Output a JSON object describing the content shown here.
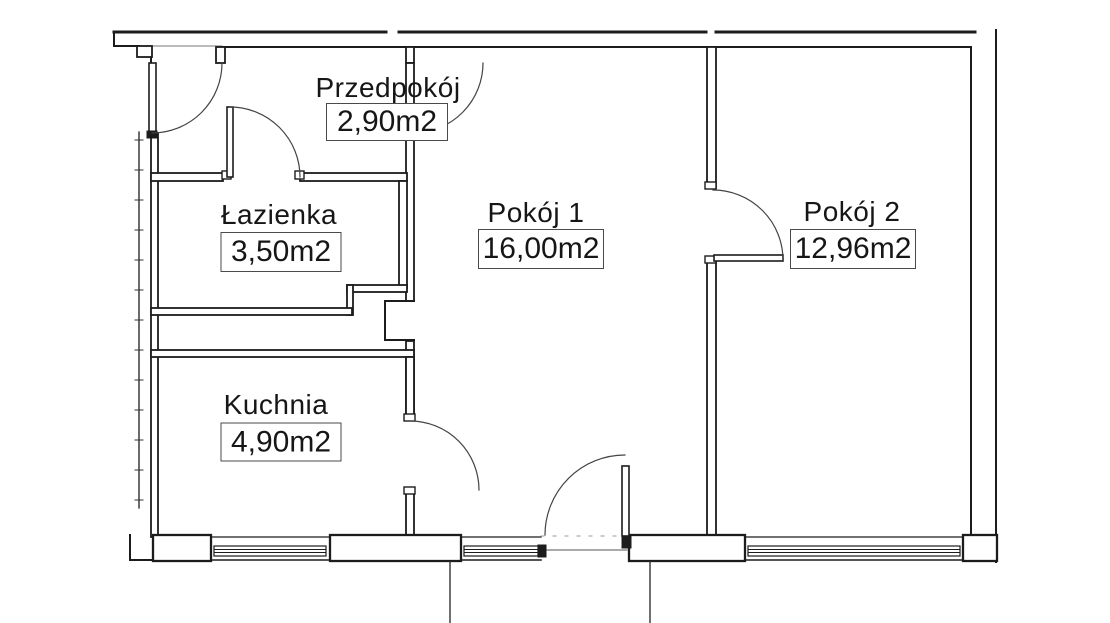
{
  "plan": {
    "background": "#ffffff",
    "line_color": "#1c1c1c",
    "rooms": [
      {
        "id": "przedpokoj",
        "name": "Przedpokój",
        "area": "2,90m2"
      },
      {
        "id": "lazienka",
        "name": "Łazienka",
        "area": "3,50m2"
      },
      {
        "id": "pokoj1",
        "name": "Pokój 1",
        "area": "16,00m2"
      },
      {
        "id": "pokoj2",
        "name": "Pokój 2",
        "area": "12,96m2"
      },
      {
        "id": "kuchnia",
        "name": "Kuchnia",
        "area": "4,90m2"
      }
    ]
  }
}
